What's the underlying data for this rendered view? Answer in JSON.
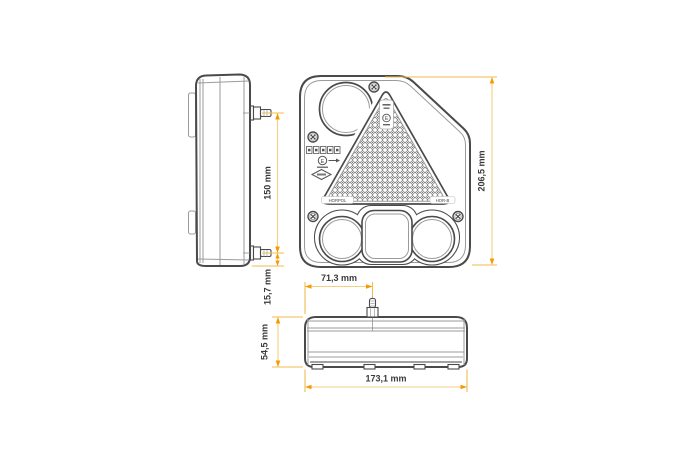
{
  "dimensions": {
    "side_bolt_spacing": "150 mm",
    "side_bolt_to_bottom": "15,7 mm",
    "front_height": "206,5 mm",
    "bottom_stud_offset": "71,3 mm",
    "bottom_depth": "54,5 mm",
    "bottom_width": "173,1 mm"
  },
  "markings": {
    "e_mark": "E",
    "apex_e_mark": "E",
    "brand_left": "HORPOL",
    "brand_right": "HOR-B"
  },
  "colors": {
    "dimension_line": "#F2CF82",
    "extension_line": "#F0BC4E",
    "arrow": "#F59B00",
    "line_dark": "#4A4A4A",
    "line_light": "#9B9B9B",
    "text": "#3A3A3C",
    "background": "#FFFFFF"
  }
}
